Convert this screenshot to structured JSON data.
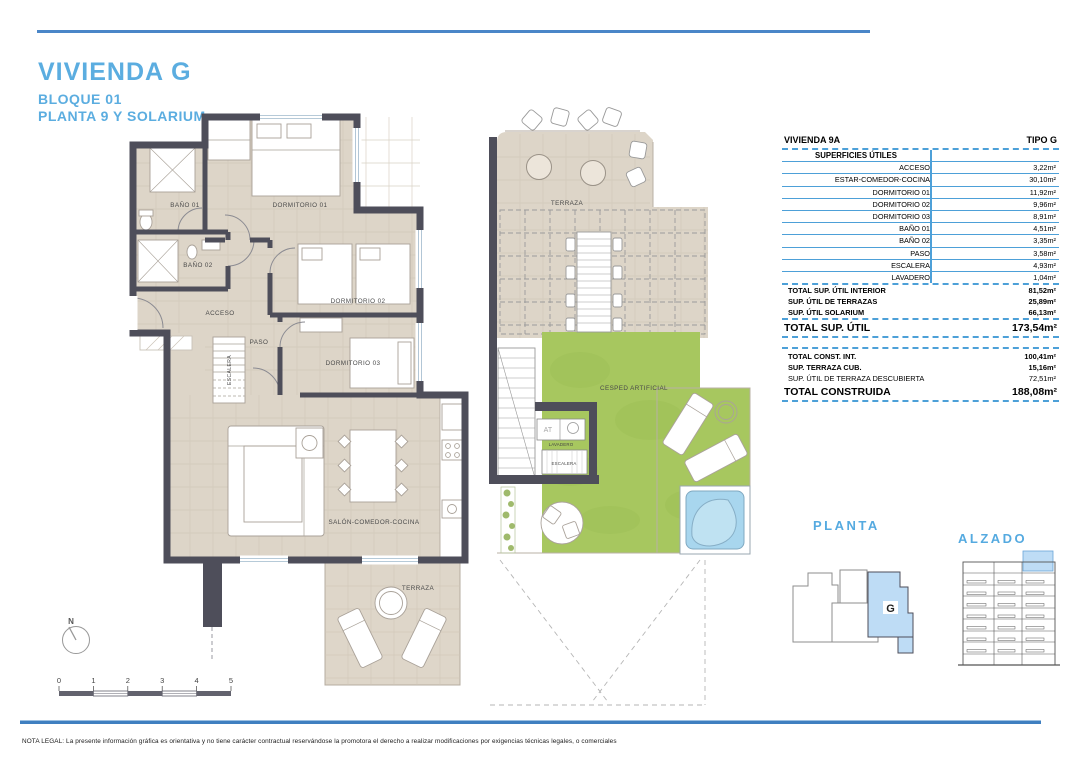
{
  "header": {
    "title": "VIVIENDA G",
    "block": "BLOQUE 01",
    "floor": "PLANTA 9 Y SOLARIUM"
  },
  "plan_left": {
    "rooms": {
      "bano1": "BAÑO 01",
      "dorm1": "DORMITORIO 01",
      "bano2": "BAÑO 02",
      "acceso": "ACCESO",
      "dorm2": "DORMITORIO 02",
      "paso": "PASO",
      "escalera": "ESCALERA",
      "dorm3": "DORMITORIO 03",
      "salon": "SALÓN-COMEDOR-COCINA",
      "terraza": "TERRAZA"
    }
  },
  "plan_right": {
    "rooms": {
      "terraza": "TERRAZA",
      "cesped": "CESPED ARTIFICIAL",
      "at": "AT",
      "lavadero": "LAVADERO",
      "escalera": "ESCALERA"
    }
  },
  "area_table": {
    "col_left": "VIVIENDA 9A",
    "col_right": "TIPO G",
    "section_title": "SUPERFICIES ÚTILES",
    "rows": [
      {
        "label": "ACCESO",
        "value": "3,22m²"
      },
      {
        "label": "ESTAR-COMEDOR-COCINA",
        "value": "30,10m²"
      },
      {
        "label": "DORMITORIO 01",
        "value": "11,92m²"
      },
      {
        "label": "DORMITORIO 02",
        "value": "9,96m²"
      },
      {
        "label": "DORMITORIO 03",
        "value": "8,91m²"
      },
      {
        "label": "BAÑO 01",
        "value": "4,51m²"
      },
      {
        "label": "BAÑO 02",
        "value": "3,35m²"
      },
      {
        "label": "PASO",
        "value": "3,58m²"
      },
      {
        "label": "ESCALERA",
        "value": "4,93m²"
      },
      {
        "label": "LAVADERO",
        "value": "1,04m²"
      }
    ],
    "subtotals": [
      {
        "label": "TOTAL SUP. ÚTIL INTERIOR",
        "value": "81,52m²"
      },
      {
        "label": "SUP. ÚTIL DE TERRAZAS",
        "value": "25,89m²"
      },
      {
        "label": "SUP. ÚTIL SOLARIUM",
        "value": "66,13m²"
      }
    ],
    "total_util": {
      "label": "TOTAL SUP. ÚTIL",
      "value": "173,54m²"
    },
    "construida_rows": [
      {
        "label": "TOTAL CONST. INT.",
        "value": "100,41m²"
      },
      {
        "label": "SUP. TERRAZA CUB.",
        "value": "15,16m²"
      },
      {
        "label": "SUP. ÚTIL DE TERRAZA DESCUBIERTA",
        "value": "72,51m²"
      }
    ],
    "total_construida": {
      "label": "TOTAL CONSTRUIDA",
      "value": "188,08m²"
    }
  },
  "key_plan": {
    "planta_label": "PLANTA",
    "alzado_label": "ALZADO",
    "unit": "G"
  },
  "compass": {
    "label": "N"
  },
  "scale_bar": {
    "ticks": [
      "0",
      "1",
      "2",
      "3",
      "4",
      "5"
    ]
  },
  "footer": {
    "legal": "NOTA LEGAL: La presente información gráfica es orientativa y no tiene carácter contractual reservándose la promotora el derecho a realizar modificaciones por exigencias técnicas legales, o comerciales"
  },
  "colors": {
    "accent_blue": "#5bade0",
    "rule_blue": "#4a86c8",
    "table_line_blue": "#4da0d8",
    "wall_gray": "#4e4e5a",
    "floor_beige": "#ddd5c8",
    "grass_green": "#a7c75f",
    "pool_blue": "#a8d6ee",
    "unit_highlight": "#bedcf5"
  }
}
